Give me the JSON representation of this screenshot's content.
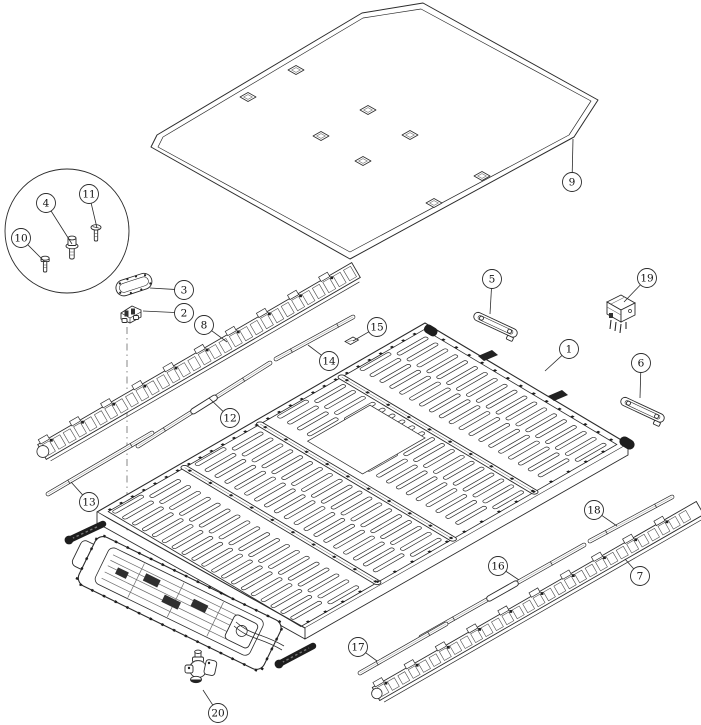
{
  "figure": {
    "kind": "exploded-parts-line-drawing",
    "background": "#ffffff",
    "line_color": "#2b2b2b",
    "fine_line_color": "#6a6a6a",
    "dark_fill": "#1e1e1e",
    "balloon_radius": 9.5,
    "balloon_font_size": 10.5
  },
  "callouts": [
    {
      "label": "1",
      "cx": 569,
      "cy": 349,
      "lx": 545,
      "ly": 371
    },
    {
      "label": "2",
      "cx": 184,
      "cy": 313,
      "lx": 143,
      "ly": 311
    },
    {
      "label": "3",
      "cx": 184,
      "cy": 290,
      "lx": 150,
      "ly": 288
    },
    {
      "label": "4",
      "cx": 46,
      "cy": 203,
      "lx": 72,
      "ly": 244
    },
    {
      "label": "5",
      "cx": 492,
      "cy": 279,
      "lx": 490,
      "ly": 314
    },
    {
      "label": "6",
      "cx": 641,
      "cy": 363,
      "lx": 640,
      "ly": 398
    },
    {
      "label": "7",
      "cx": 640,
      "cy": 576,
      "lx": 625,
      "ly": 559
    },
    {
      "label": "8",
      "cx": 204,
      "cy": 325,
      "lx": 227,
      "ly": 342
    },
    {
      "label": "9",
      "cx": 572,
      "cy": 182,
      "lx": 573,
      "ly": 139
    },
    {
      "label": "10",
      "cx": 21,
      "cy": 238,
      "lx": 45,
      "ly": 262
    },
    {
      "label": "11",
      "cx": 89,
      "cy": 194,
      "lx": 97,
      "ly": 228
    },
    {
      "label": "12",
      "cx": 230,
      "cy": 418,
      "lx": 209,
      "ly": 398
    },
    {
      "label": "13",
      "cx": 89,
      "cy": 502,
      "lx": 71,
      "ly": 482
    },
    {
      "label": "14",
      "cx": 329,
      "cy": 361,
      "lx": 308,
      "ly": 345
    },
    {
      "label": "15",
      "cx": 377,
      "cy": 327,
      "lx": 353,
      "ly": 341
    },
    {
      "label": "16",
      "cx": 498,
      "cy": 566,
      "lx": 519,
      "ly": 580
    },
    {
      "label": "17",
      "cx": 358,
      "cy": 647,
      "lx": 377,
      "ly": 661
    },
    {
      "label": "18",
      "cx": 594,
      "cy": 510,
      "lx": 617,
      "ly": 526
    },
    {
      "label": "19",
      "cx": 647,
      "cy": 278,
      "lx": 624,
      "ly": 302
    },
    {
      "label": "20",
      "cx": 218,
      "cy": 713,
      "lx": 203,
      "ly": 690
    }
  ]
}
